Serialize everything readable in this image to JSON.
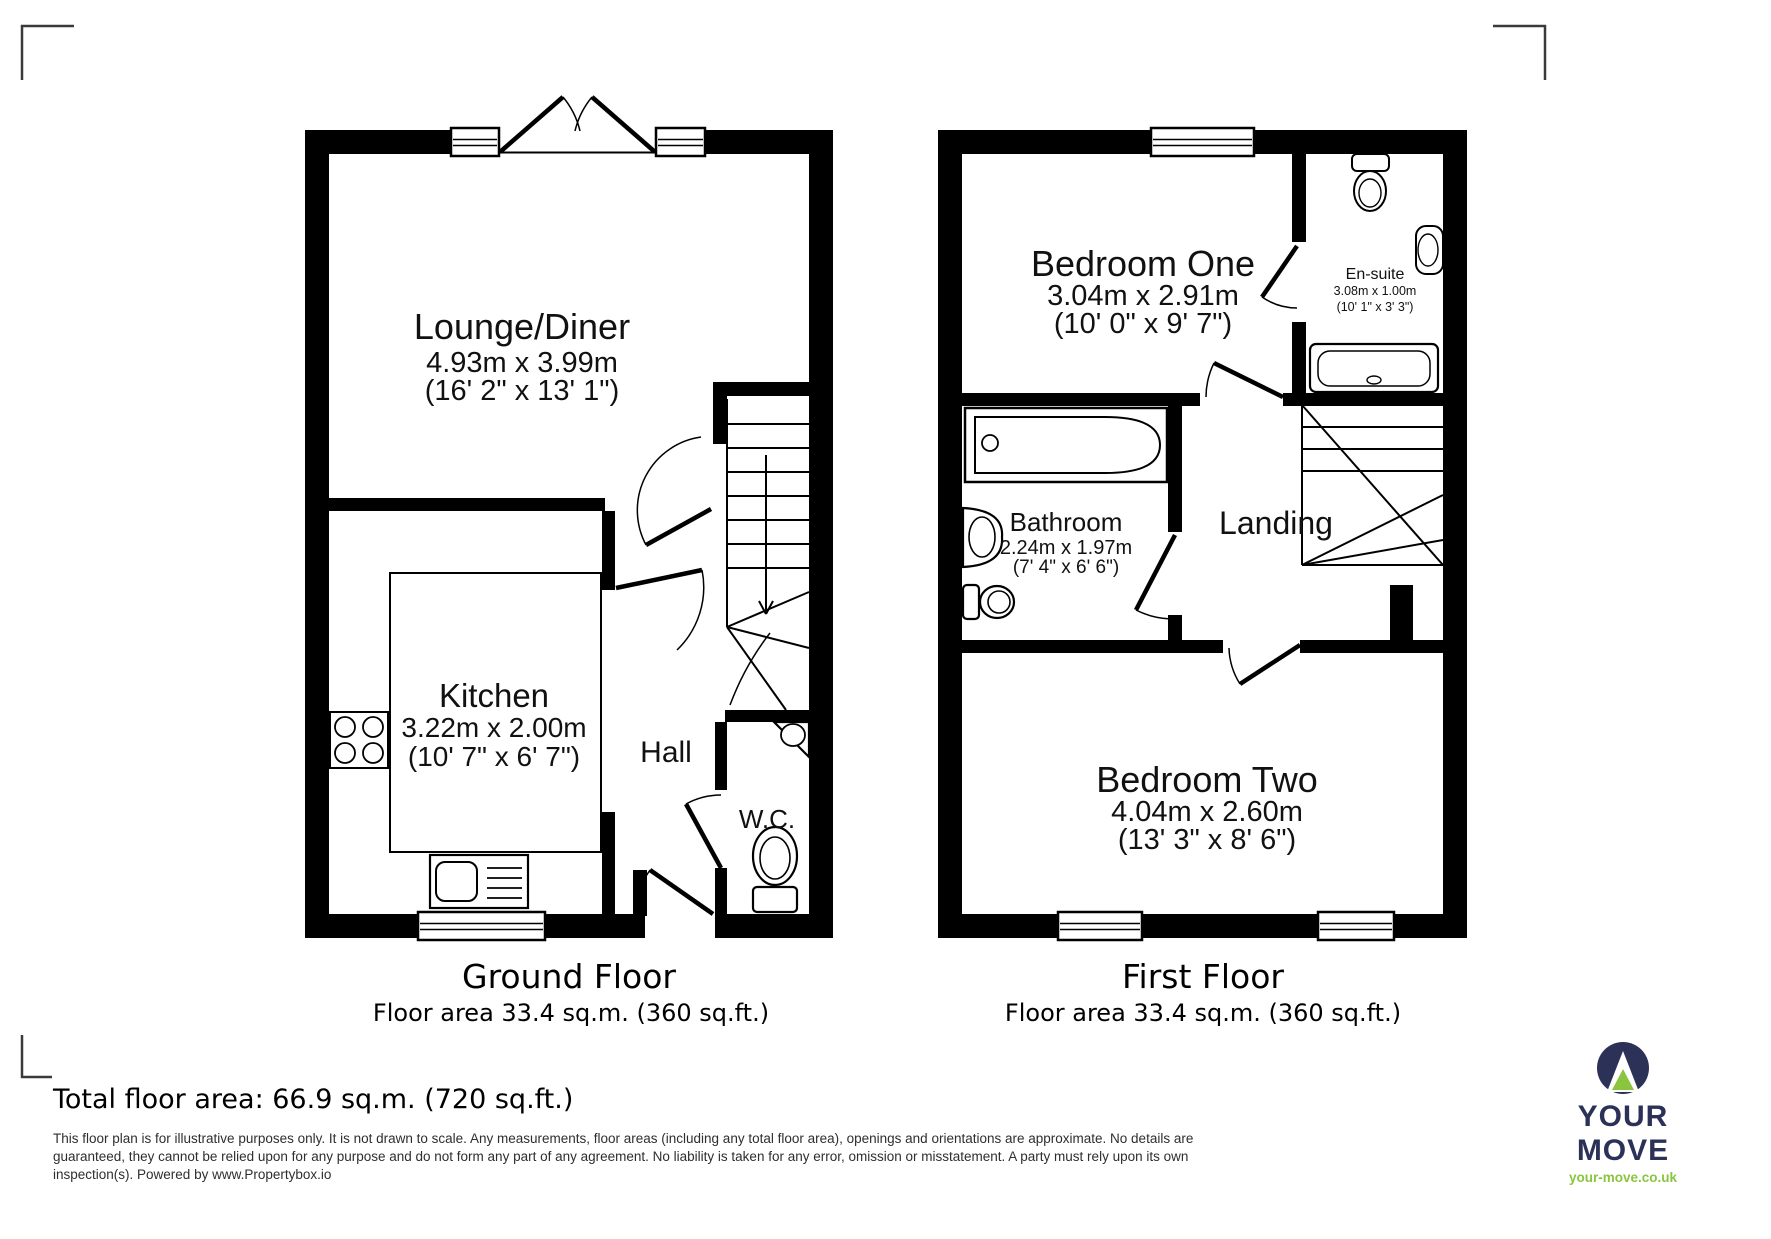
{
  "ground_floor": {
    "title": "Ground Floor",
    "area": "Floor area 33.4 sq.m. (360 sq.ft.)",
    "rooms": {
      "lounge": {
        "name": "Lounge/Diner",
        "metric": "4.93m x 3.99m",
        "imperial": "(16' 2\" x 13' 1\")"
      },
      "kitchen": {
        "name": "Kitchen",
        "metric": "3.22m x 2.00m",
        "imperial": "(10' 7\" x 6' 7\")"
      },
      "hall": {
        "name": "Hall"
      },
      "wc": {
        "name": "W.C."
      }
    }
  },
  "first_floor": {
    "title": "First Floor",
    "area": "Floor area 33.4 sq.m. (360 sq.ft.)",
    "rooms": {
      "bedroom_one": {
        "name": "Bedroom One",
        "metric": "3.04m x 2.91m",
        "imperial": "(10' 0\" x 9' 7\")"
      },
      "en_suite": {
        "name": "En-suite",
        "metric": "3.08m x 1.00m",
        "imperial": "(10' 1\" x 3' 3\")"
      },
      "bathroom": {
        "name": "Bathroom",
        "metric": "2.24m x 1.97m",
        "imperial": "(7' 4\" x 6' 6\")"
      },
      "landing": {
        "name": "Landing"
      },
      "bedroom_two": {
        "name": "Bedroom Two",
        "metric": "4.04m x 2.60m",
        "imperial": "(13' 3\" x 8' 6\")"
      }
    }
  },
  "footer": {
    "total_area": "Total floor area: 66.9 sq.m. (720 sq.ft.)",
    "disclaimer_lines": [
      "This floor plan is for illustrative purposes only. It is not drawn to scale. Any measurements, floor areas (including any total floor area), openings and orientations are approximate. No details are",
      "guaranteed, they cannot be relied upon for any purpose and do not form any part of any agreement. No liability is taken for any error, omission or misstatement. A party must rely upon its own",
      "inspection(s). Powered by www.Propertybox.io"
    ],
    "logo": {
      "brand": "YOUR MOVE",
      "url": "your-move.co.uk"
    }
  },
  "colors": {
    "wall": "#000000",
    "brand_navy": "#2c3157",
    "brand_green": "#8bc53f"
  }
}
